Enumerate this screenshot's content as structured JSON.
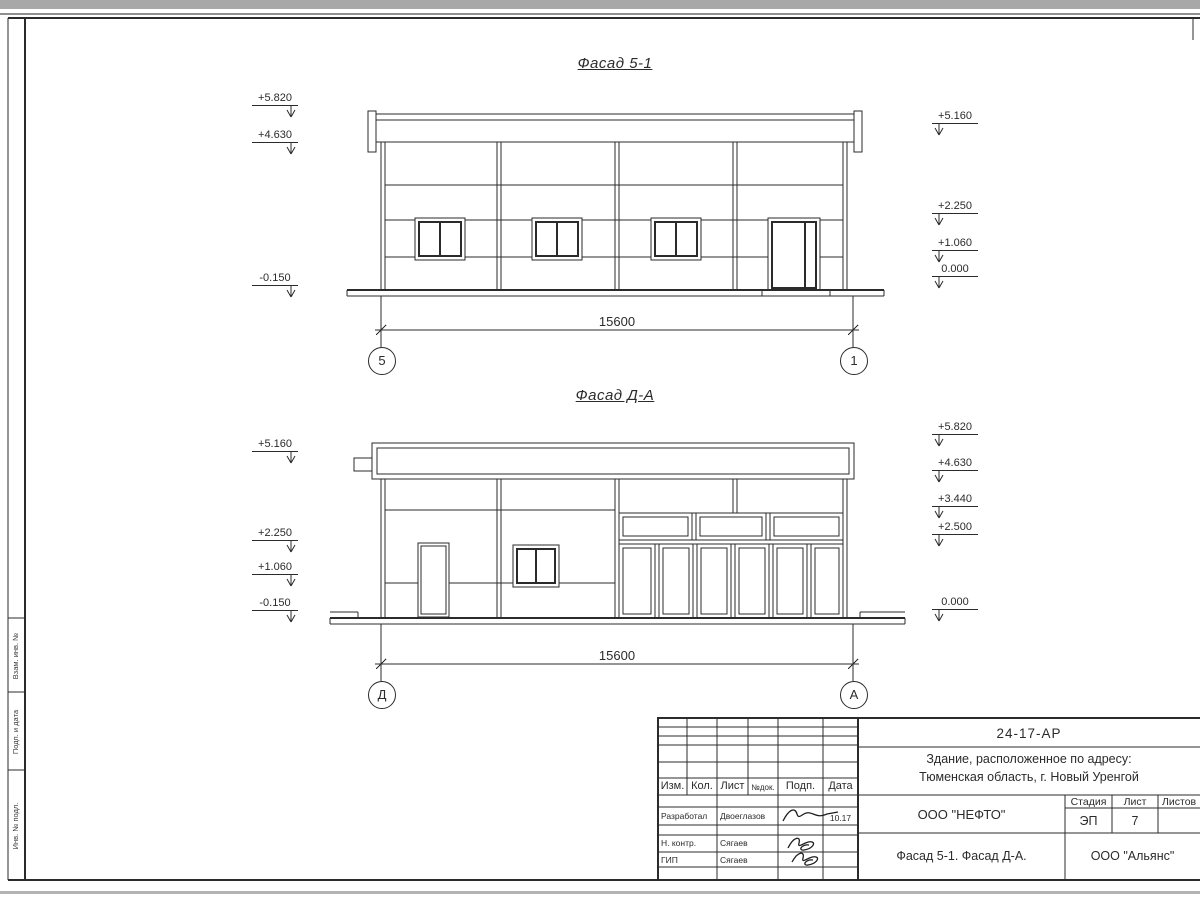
{
  "facade1": {
    "title": "Фасад 5-1",
    "left_marks": [
      "+5.820",
      "+4.630",
      "-0.150"
    ],
    "right_marks": [
      "+5.160",
      "+2.250",
      "+1.060",
      "0.000"
    ],
    "dimension": "15600",
    "axis_left": "5",
    "axis_right": "1"
  },
  "facade2": {
    "title": "Фасад Д-А",
    "left_marks": [
      "+5.160",
      "+2.250",
      "+1.060",
      "-0.150"
    ],
    "right_marks": [
      "+5.820",
      "+4.630",
      "+3.440",
      "+2.500",
      "0.000"
    ],
    "dimension": "15600",
    "axis_left": "Д",
    "axis_right": "А"
  },
  "side_strip": {
    "labels": [
      "Взам. инв. №",
      "Подп. и дата",
      "Инв. № подл."
    ]
  },
  "title_block": {
    "doc_number": "24-17-АР",
    "address_line1": "Здание, расположенное по адресу:",
    "address_line2": "Тюменская область, г. Новый Уренгой",
    "columns": [
      "Изм.",
      "Кол.",
      "Лист",
      "№док.",
      "Подп.",
      "Дата"
    ],
    "personnel": [
      {
        "role": "Разработал",
        "name": "Двоеглазов",
        "date": "10.17"
      },
      {
        "role": "Н. контр.",
        "name": "Сягаев",
        "date": ""
      },
      {
        "role": "ГИП",
        "name": "Сягаев",
        "date": ""
      }
    ],
    "org": "ООО \"НЕФТО\"",
    "stage_label": "Стадия",
    "sheet_label": "Лист",
    "sheets_label": "Листов",
    "stage_value": "ЭП",
    "sheet_value": "7",
    "sheets_value": "",
    "drawing_title": "Фасад 5-1. Фасад Д-А.",
    "company": "ООО \"Альянс\""
  }
}
